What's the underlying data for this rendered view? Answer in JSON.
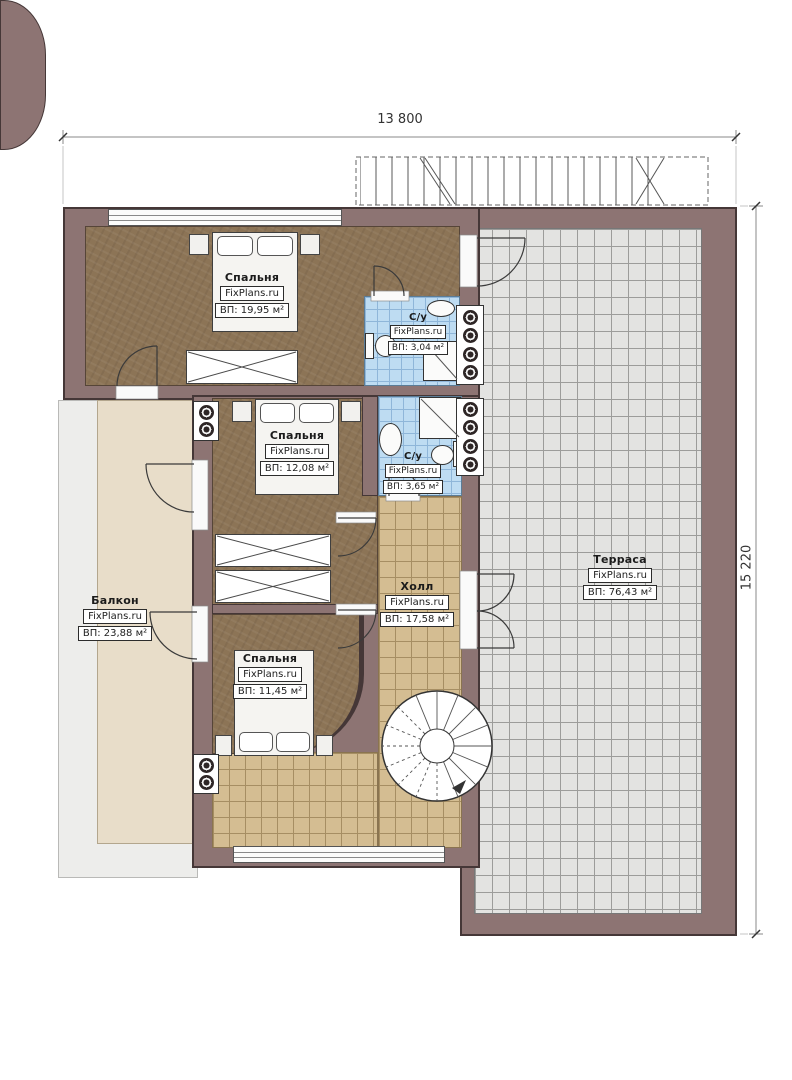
{
  "plan": {
    "type": "apartment-floor-plan",
    "branding": "FixPlans.ru"
  },
  "dimensions": {
    "width": "13 800",
    "height": "15 220"
  },
  "rooms": [
    {
      "id": "bedroom-1",
      "name": "Спальня",
      "area": "ВП: 19,95 м²"
    },
    {
      "id": "bathroom-1",
      "name": "С/у",
      "area": "ВП: 3,04 м²"
    },
    {
      "id": "bedroom-2",
      "name": "Спальня",
      "area": "ВП: 12,08 м²"
    },
    {
      "id": "bathroom-2",
      "name": "С/у",
      "area": "ВП: 3,65 м²"
    },
    {
      "id": "balcony",
      "name": "Балкон",
      "area": "ВП: 23,88 м²"
    },
    {
      "id": "hall",
      "name": "Холл",
      "area": "ВП: 17,58 м²"
    },
    {
      "id": "terrace",
      "name": "Терраса",
      "area": "ВП: 76,43 м²"
    },
    {
      "id": "bedroom-3",
      "name": "Спальня",
      "area": "ВП: 11,45 м²"
    }
  ],
  "colors": {
    "wall": "#8d7473",
    "wall_edge": "#453737",
    "bedroom_floor": "#8c7456",
    "bathroom_tile": "#bedcf2",
    "hall_tile": "#d4bd92",
    "terrace_tile": "#e3e3e1",
    "balcony_floor": "#e8ddc9"
  }
}
